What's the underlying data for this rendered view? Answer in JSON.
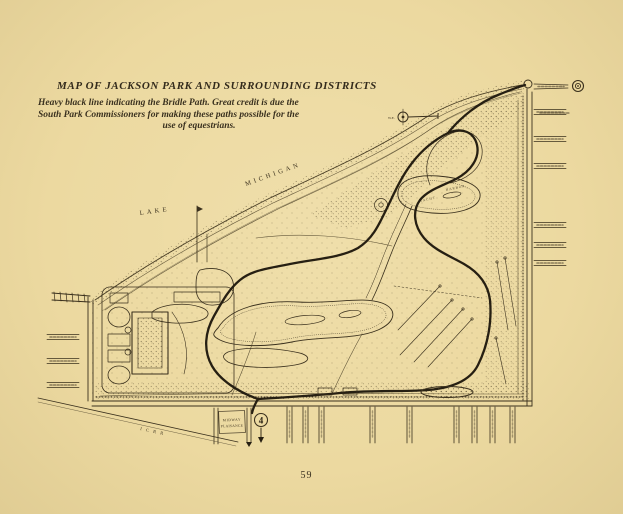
{
  "page": {
    "number": "59"
  },
  "colors": {
    "paper": "#ecd9a0",
    "ink": "#3a301d",
    "ink_heavy": "#261f12"
  },
  "header": {
    "title": "MAP OF JACKSON PARK AND SURROUNDING DISTRICTS",
    "caption": [
      "Heavy black line indicating the Bridle Path.  Great credit is due the",
      "South Park Commissioners for making these paths possible for the",
      "use of equestrians."
    ]
  },
  "map": {
    "labels": {
      "lake": "LAKE",
      "michigan": "MICHIGAN",
      "yacht": "YACHT",
      "harbor": "HARBOR",
      "midway_line1": "MIDWAY",
      "midway_line2": "PLAISANCE",
      "icrr": "I C R R",
      "compass": "W.E.",
      "north_mark": "4"
    }
  }
}
